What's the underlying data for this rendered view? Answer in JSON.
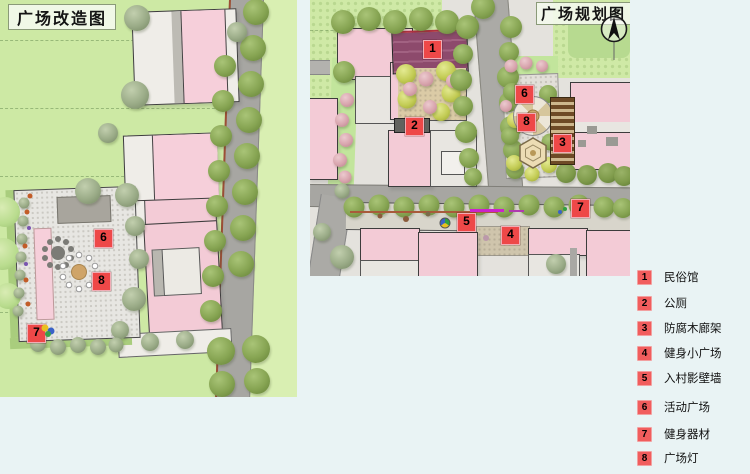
{
  "page": {
    "background": "#e9f3f4"
  },
  "left_map": {
    "title": "广场改造图",
    "markers": {
      "m6": "6",
      "m7": "7",
      "m8": "8"
    }
  },
  "right_map": {
    "title": "广场规划图",
    "markers": {
      "m1": "1",
      "m2": "2",
      "m3": "3",
      "m4": "4",
      "m5": "5",
      "m6": "6",
      "m7": "7",
      "m8": "8"
    }
  },
  "legend": {
    "items": [
      {
        "num": "1",
        "label": "民俗馆"
      },
      {
        "num": "2",
        "label": "公厕"
      },
      {
        "num": "3",
        "label": "防腐木廊架"
      },
      {
        "num": "4",
        "label": "健身小广场"
      },
      {
        "num": "5",
        "label": "入村影壁墙"
      },
      {
        "num": "6",
        "label": "活动广场"
      },
      {
        "num": "7",
        "label": "健身器材"
      },
      {
        "num": "8",
        "label": "广场灯"
      }
    ]
  },
  "colors": {
    "marker_red": "#ee4848",
    "legend_red": "#f15d5d",
    "field_green": "#cde9a4",
    "building_pink": "#f3cbd6",
    "museum_purple": "#8d4a6c",
    "road_gray": "#a7a6a2",
    "background": "#e9f3f4"
  }
}
